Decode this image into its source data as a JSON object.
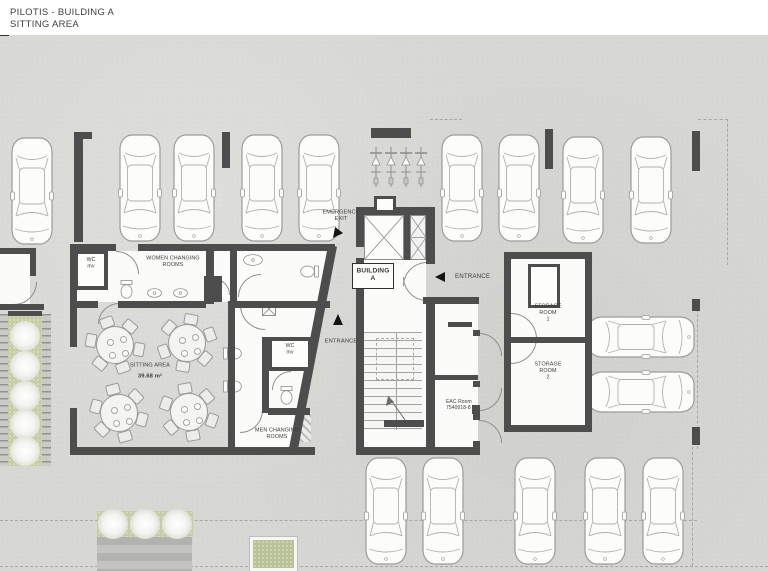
{
  "title": {
    "line1": "PILOTIS - BUILDING A",
    "line2": "SITTING AREA"
  },
  "labels": {
    "wc_left": {
      "x": 91,
      "y": 257,
      "fs": 5.2,
      "align": "c",
      "lines": [
        "WC",
        "mv"
      ]
    },
    "women": {
      "x": 173,
      "y": 255,
      "fs": 5.4,
      "align": "c",
      "lines": [
        "WOMEN CHANGING",
        "ROOMS"
      ]
    },
    "wc_mid": {
      "x": 290,
      "y": 343,
      "fs": 5.2,
      "align": "c",
      "lines": [
        "WC",
        "mv"
      ]
    },
    "men": {
      "x": 277,
      "y": 427,
      "fs": 5.4,
      "align": "c",
      "lines": [
        "MEN CHANGING",
        "ROOMS"
      ]
    },
    "sitting_name": {
      "x": 150,
      "y": 362,
      "fs": 5.6,
      "align": "c",
      "lines": [
        "SITTING AREA"
      ]
    },
    "sitting_area": {
      "x": 150,
      "y": 373,
      "fs": 5.8,
      "align": "c",
      "bold": true,
      "lines": [
        "39.68 m²"
      ]
    },
    "emergency": {
      "x": 341,
      "y": 209,
      "fs": 5.6,
      "align": "c",
      "lines": [
        "EMERGENCY",
        "EXIT"
      ]
    },
    "building": {
      "x": 373,
      "y": 267,
      "fs": 6.6,
      "align": "c",
      "bold": true,
      "lines": [
        "BUILDING",
        "A"
      ]
    },
    "entrance_main": {
      "x": 455,
      "y": 273,
      "fs": 6.2,
      "align": "l",
      "lines": [
        "ENTRANCE"
      ]
    },
    "entrance_side": {
      "x": 341,
      "y": 338,
      "fs": 5.8,
      "align": "c",
      "lines": [
        "ENTRANCE"
      ]
    },
    "storage1": {
      "x": 548,
      "y": 303,
      "fs": 5.4,
      "align": "c",
      "lines": [
        "STORAGE",
        "ROOM",
        "1"
      ]
    },
    "storage2": {
      "x": 548,
      "y": 361,
      "fs": 5.4,
      "align": "c",
      "lines": [
        "STORAGE",
        "ROOM",
        "2"
      ]
    },
    "eac": {
      "x": 446,
      "y": 399,
      "fs": 5.0,
      "align": "l",
      "lines": [
        "EAC Room",
        "7540018-8"
      ]
    }
  },
  "colors": {
    "wall": "#4d4d4d",
    "background": "#d7d7d4",
    "room": "#fbfbfa",
    "green": "#c6cda6",
    "arrow": "#141414"
  },
  "geometry": {
    "walls": [
      [
        74,
        132,
        18,
        7
      ],
      [
        74,
        132,
        9,
        110
      ],
      [
        222,
        132,
        8,
        36
      ],
      [
        371,
        128,
        40,
        10
      ],
      [
        545,
        129,
        8,
        40
      ],
      [
        692,
        131,
        8,
        40
      ],
      [
        0,
        248,
        36,
        6
      ],
      [
        30,
        248,
        6,
        28
      ],
      [
        0,
        304,
        44,
        6
      ],
      [
        70,
        244,
        46,
        7
      ],
      [
        138,
        244,
        100,
        7
      ],
      [
        70,
        244,
        7,
        66
      ],
      [
        70,
        301,
        28,
        7
      ],
      [
        118,
        301,
        88,
        7
      ],
      [
        206,
        244,
        8,
        60
      ],
      [
        204,
        276,
        18,
        26
      ],
      [
        230,
        250,
        7,
        57
      ],
      [
        237,
        244,
        98,
        7
      ],
      [
        230,
        301,
        100,
        7
      ],
      [
        70,
        301,
        7,
        46
      ],
      [
        70,
        408,
        7,
        47
      ],
      [
        70,
        447,
        245,
        8
      ],
      [
        228,
        301,
        7,
        150
      ],
      [
        262,
        337,
        7,
        76
      ],
      [
        268,
        408,
        42,
        7
      ],
      [
        356,
        207,
        8,
        40
      ],
      [
        356,
        258,
        8,
        51
      ],
      [
        356,
        309,
        8,
        146
      ],
      [
        356,
        207,
        76,
        8
      ],
      [
        404,
        215,
        6,
        45
      ],
      [
        426,
        207,
        9,
        57
      ],
      [
        423,
        297,
        56,
        7
      ],
      [
        426,
        297,
        9,
        158
      ],
      [
        356,
        447,
        124,
        8
      ],
      [
        384,
        420,
        40,
        7
      ],
      [
        448,
        322,
        24,
        5
      ],
      [
        428,
        375,
        50,
        5
      ],
      [
        504,
        252,
        88,
        7
      ],
      [
        504,
        252,
        7,
        180
      ],
      [
        585,
        252,
        7,
        180
      ],
      [
        504,
        425,
        88,
        7
      ],
      [
        504,
        337,
        88,
        6
      ],
      [
        692,
        299,
        8,
        12
      ],
      [
        692,
        427,
        8,
        18
      ],
      [
        8,
        311,
        34,
        5
      ],
      [
        544,
        270,
        9,
        34
      ],
      [
        472,
        405,
        8,
        9
      ],
      [
        473,
        330,
        7,
        6
      ],
      [
        473,
        381,
        7,
        6
      ],
      [
        473,
        414,
        7,
        6
      ],
      [
        473,
        441,
        7,
        6
      ]
    ],
    "rooms": [
      [
        0,
        254,
        30,
        50
      ],
      [
        76,
        251,
        130,
        51
      ],
      [
        214,
        251,
        16,
        51
      ],
      [
        364,
        215,
        62,
        94
      ],
      [
        364,
        309,
        62,
        138
      ],
      [
        435,
        304,
        43,
        143
      ],
      [
        511,
        259,
        74,
        78
      ],
      [
        511,
        343,
        74,
        82
      ]
    ],
    "clip_rooms": [
      {
        "x": 237,
        "y": 251,
        "w": 95,
        "h": 50,
        "poly": "polygon(0 0, 94px 0, 86px 100%, 0 100%)"
      },
      {
        "x": 235,
        "y": 308,
        "w": 90,
        "h": 140,
        "poly": "polygon(0 0, 89px 0, 58px 100%, 0 100%)"
      }
    ],
    "diagonal": {
      "x": 307.5,
      "y": 243.5,
      "w": 9,
      "h": 212,
      "rot": 10.9
    },
    "dashes": [
      [
        430,
        119,
        32,
        "h"
      ],
      [
        698,
        119,
        30,
        "h"
      ],
      [
        727,
        119,
        146,
        "v"
      ],
      [
        697,
        309,
        140,
        "v"
      ],
      [
        0,
        520,
        697,
        "h"
      ],
      [
        0,
        566,
        768,
        "h"
      ],
      [
        692,
        447,
        119,
        "v"
      ]
    ],
    "arcs": [
      [
        116,
        251,
        22,
        "tr"
      ],
      [
        98,
        303,
        20,
        "tl"
      ],
      [
        213,
        278,
        16,
        "tr"
      ],
      [
        238,
        274,
        22,
        "tl"
      ],
      [
        14,
        282,
        22,
        "br"
      ],
      [
        403,
        262,
        23,
        "tl"
      ],
      [
        403,
        277,
        23,
        "bl"
      ],
      [
        511,
        313,
        25,
        "tr"
      ],
      [
        511,
        338,
        25,
        "br"
      ],
      [
        479,
        333,
        22,
        "tr"
      ],
      [
        479,
        388,
        22,
        "br"
      ],
      [
        479,
        420,
        22,
        "tr"
      ],
      [
        240,
        305,
        24,
        "bl"
      ],
      [
        272,
        371,
        18,
        "tl"
      ],
      [
        240,
        410,
        22,
        "br"
      ]
    ],
    "hatches": [
      [
        0,
        314,
        8,
        152,
        "ticks"
      ],
      [
        42,
        314,
        9,
        152,
        "ticks"
      ],
      [
        97,
        537,
        95,
        34,
        "stripes"
      ],
      [
        228,
        414,
        16,
        34,
        "diag"
      ],
      [
        293,
        412,
        18,
        30,
        "diag"
      ],
      [
        364,
        432,
        58,
        15,
        "diag"
      ]
    ],
    "greens": [
      [
        8,
        314,
        34,
        152
      ],
      [
        97,
        511,
        96,
        26
      ]
    ],
    "planter": [
      250,
      537,
      47,
      34
    ],
    "trees": [
      [
        25,
        336,
        15
      ],
      [
        25,
        366,
        15
      ],
      [
        25,
        396,
        15
      ],
      [
        25,
        424,
        15
      ],
      [
        25,
        451,
        15
      ],
      [
        113,
        524,
        15
      ],
      [
        145,
        524,
        15
      ],
      [
        177,
        524,
        15
      ]
    ],
    "cars": {
      "top": [
        [
          10,
          136
        ],
        [
          118,
          133
        ],
        [
          172,
          133
        ],
        [
          240,
          133
        ],
        [
          297,
          133
        ],
        [
          440,
          133
        ],
        [
          497,
          133
        ],
        [
          561,
          135
        ],
        [
          629,
          135
        ]
      ],
      "bottom": [
        [
          364,
          456
        ],
        [
          421,
          456
        ],
        [
          513,
          456
        ],
        [
          583,
          456
        ],
        [
          641,
          456
        ]
      ],
      "right": [
        [
          592,
          317
        ],
        [
          592,
          372
        ]
      ]
    },
    "car_size": {
      "w": 44,
      "h": 110
    },
    "bikes": [
      [
        369,
        146
      ],
      [
        384,
        146
      ],
      [
        399,
        146
      ],
      [
        414,
        146
      ]
    ],
    "tables": [
      [
        114,
        344,
        10
      ],
      [
        186,
        342,
        40
      ],
      [
        118,
        412,
        75
      ],
      [
        188,
        411,
        20
      ]
    ],
    "toilets": [
      [
        119,
        280,
        0
      ],
      [
        302,
        262,
        90
      ],
      [
        225,
        344,
        -90
      ],
      [
        225,
        377,
        -90
      ],
      [
        279,
        386,
        0
      ]
    ],
    "sinks": [
      [
        147,
        285,
        15,
        10
      ],
      [
        173,
        285,
        15,
        10
      ],
      [
        243,
        253,
        20,
        12
      ]
    ],
    "boxes": [
      {
        "x": 74,
        "y": 250,
        "w": 34,
        "h": 40,
        "b": 4,
        "name": "wc-room-left"
      },
      {
        "x": 268,
        "y": 337,
        "w": 44,
        "h": 34,
        "b": 4,
        "name": "wc-room-mid"
      },
      {
        "x": 374,
        "y": 196,
        "w": 22,
        "h": 17,
        "b": 3,
        "name": "column"
      },
      {
        "x": 528,
        "y": 264,
        "w": 32,
        "h": 44,
        "b": 3,
        "name": "storage-shaft"
      },
      {
        "x": 352,
        "y": 263,
        "w": 42,
        "h": 26,
        "b": 1.4,
        "name": "building-a-tag-box"
      }
    ],
    "xboxes": [
      [
        364,
        215,
        40,
        45
      ],
      [
        262,
        302,
        14,
        14
      ],
      [
        531,
        267,
        13,
        13
      ]
    ],
    "duct": [
      410,
      215,
      16,
      45
    ],
    "stairs": {
      "x": 364,
      "y": 332,
      "w": 58,
      "h": 98
    }
  }
}
